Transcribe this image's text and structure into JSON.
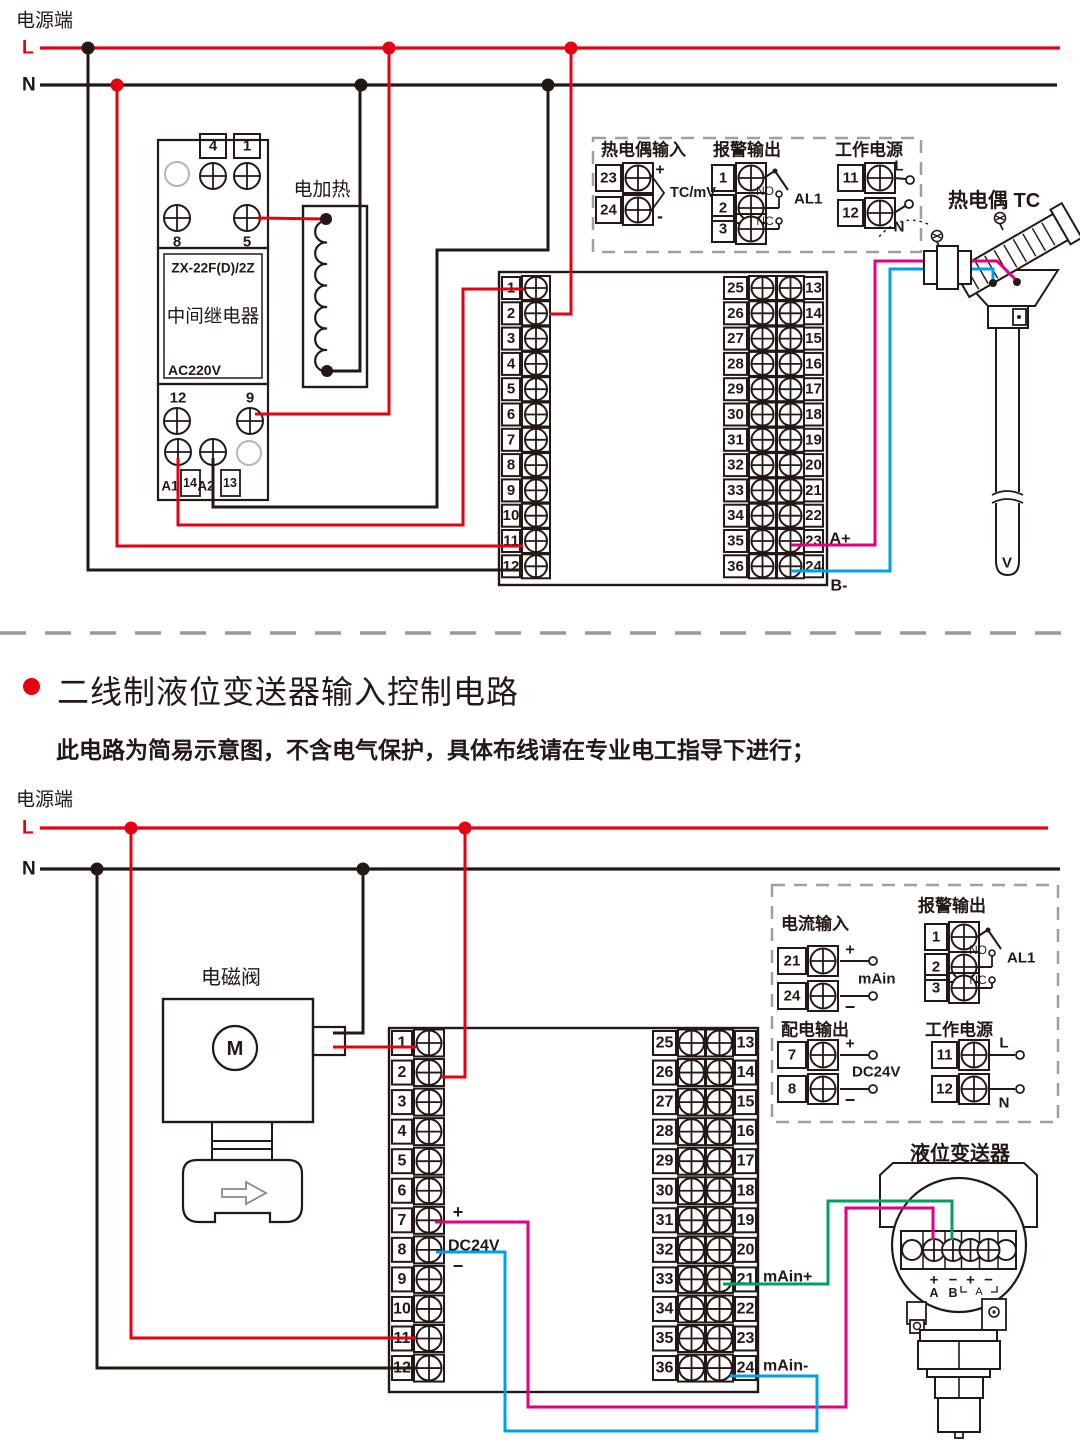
{
  "colors": {
    "red": "#e60012",
    "black": "#231815",
    "magenta": "#e4007f",
    "blue": "#00a0e9",
    "green": "#00a063",
    "gray": "#9f9fa0"
  },
  "section_title": {
    "title": "二线制液位变送器输入控制电路",
    "note": "此电路为简易示意图，不含电气保护，具体布线请在专业电工指导下进行；"
  },
  "top_circuit": {
    "power_label": "电源端",
    "line_l": "L",
    "line_n": "N",
    "relay": {
      "t_row1": [
        "4",
        "1"
      ],
      "t_row2": [
        "8",
        "5"
      ],
      "model": "ZX-22F(D)/2Z",
      "name": "中间继电器",
      "voltage": "AC220V",
      "t_row3": [
        "12",
        "9"
      ],
      "bottom_labels": [
        "A1",
        "14",
        "A2",
        "13"
      ]
    },
    "heater_label": "电加热",
    "panel": {
      "tc_input": {
        "title": "热电偶输入",
        "t1": "23",
        "t2": "24",
        "plus": "+",
        "minus": "-",
        "note": "TC/mV"
      },
      "alarm": {
        "title": "报警输出",
        "t": [
          "1",
          "2",
          "3"
        ],
        "no": "NO",
        "nc": "NC",
        "name": "AL1"
      },
      "power": {
        "title": "工作电源",
        "t1": "11",
        "t2": "12",
        "l": "L",
        "n": "N"
      }
    },
    "tc_label": "热电偶 TC",
    "tc_tip": "V",
    "block": {
      "left": [
        "1",
        "2",
        "3",
        "4",
        "5",
        "6",
        "7",
        "8",
        "9",
        "10",
        "11",
        "12"
      ],
      "mid": [
        "25",
        "26",
        "27",
        "28",
        "29",
        "30",
        "31",
        "32",
        "33",
        "34",
        "35",
        "36"
      ],
      "right": [
        "13",
        "14",
        "15",
        "16",
        "17",
        "18",
        "19",
        "20",
        "21",
        "22",
        "23",
        "24"
      ],
      "a_plus": "A+",
      "b_minus": "B-"
    }
  },
  "bottom_circuit": {
    "power_label": "电源端",
    "line_l": "L",
    "line_n": "N",
    "solenoid": {
      "label": "电磁阀",
      "motor": "M"
    },
    "panel": {
      "current_input": {
        "title": "电流输入",
        "t1": "21",
        "t2": "24",
        "plus": "+",
        "minus": "−",
        "note": "mAin"
      },
      "alarm": {
        "title": "报警输出",
        "t": [
          "1",
          "2",
          "3"
        ],
        "no": "NO",
        "nc": "NC",
        "name": "AL1"
      },
      "dist_output": {
        "title": "配电输出",
        "t1": "7",
        "t2": "8",
        "plus": "+",
        "minus": "−",
        "note": "DC24V"
      },
      "power": {
        "title": "工作电源",
        "t1": "11",
        "t2": "12",
        "l": "L",
        "n": "N"
      }
    },
    "block": {
      "left": [
        "1",
        "2",
        "3",
        "4",
        "5",
        "6",
        "7",
        "8",
        "9",
        "10",
        "11",
        "12"
      ],
      "mid": [
        "25",
        "26",
        "27",
        "28",
        "29",
        "30",
        "31",
        "32",
        "33",
        "34",
        "35",
        "36"
      ],
      "right": [
        "13",
        "14",
        "15",
        "16",
        "17",
        "18",
        "19",
        "20",
        "21",
        "22",
        "23",
        "24"
      ],
      "plus": "+",
      "minus": "−",
      "dc": "DC24V",
      "main_plus": "mAin+",
      "main_minus": "mAin-"
    },
    "transmitter": {
      "label": "液位变送器",
      "terms": [
        "+",
        "−",
        "+",
        "−"
      ],
      "ab": [
        "A",
        "B"
      ],
      "bracket": "A"
    }
  }
}
